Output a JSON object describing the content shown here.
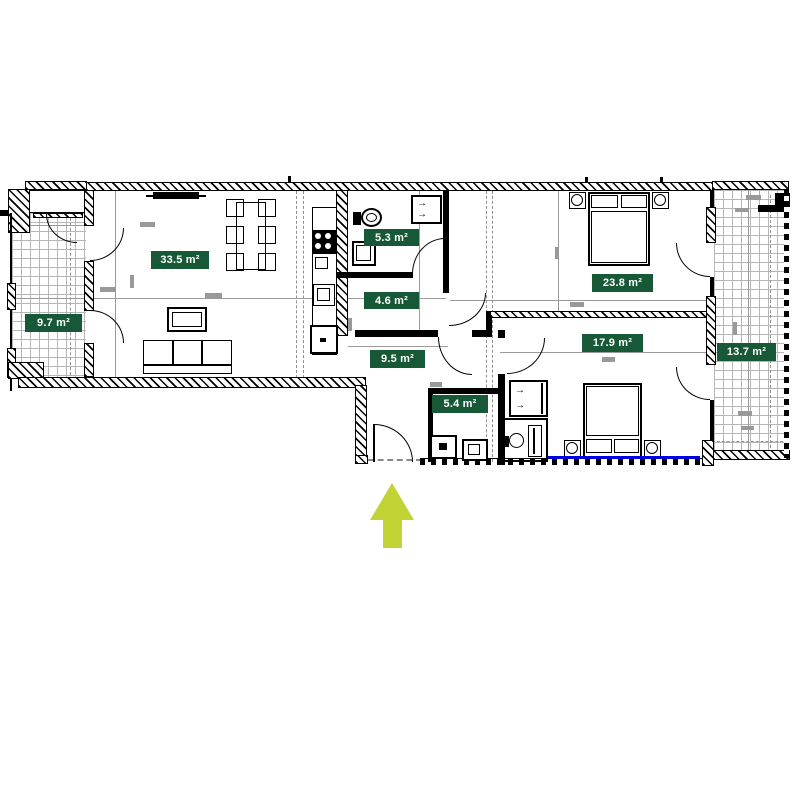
{
  "title": "apartment-floor-plan",
  "rooms": [
    {
      "name": "living-room",
      "area": "33.5 m²"
    },
    {
      "name": "balcony-left",
      "area": "9.7 m²"
    },
    {
      "name": "bathroom",
      "area": "5.3 m²"
    },
    {
      "name": "hall-small",
      "area": "4.6 m²"
    },
    {
      "name": "hallway",
      "area": "9.5 m²"
    },
    {
      "name": "laundry",
      "area": "5.4 m²"
    },
    {
      "name": "bedroom-large",
      "area": "23.8 m²"
    },
    {
      "name": "bedroom",
      "area": "17.9 m²"
    },
    {
      "name": "balcony-right",
      "area": "13.7 m²"
    }
  ],
  "icons": {
    "flow_arrow": "→",
    "entrance_arrow": "up-arrow"
  },
  "colors": {
    "room_badge": "#175837",
    "badge_text": "#ffffff",
    "entrance_arrow": "#c2d335",
    "window_marker": "#0000e0",
    "walls": "#000000",
    "tile_grid": "#b6b6b6",
    "dimension_marks": "#999999"
  }
}
